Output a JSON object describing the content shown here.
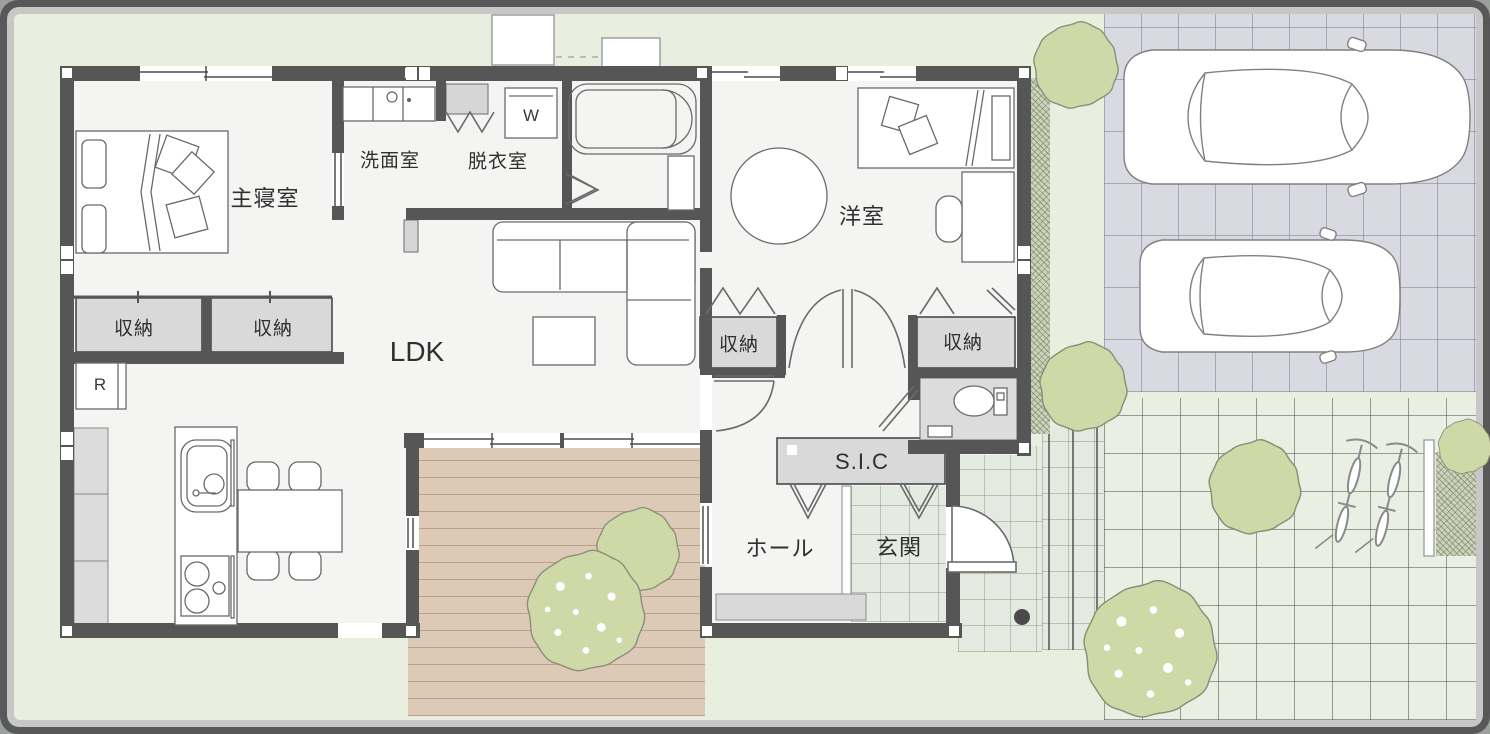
{
  "floorplan": {
    "labels": {
      "master_bedroom": "主寝室",
      "closet": "収納",
      "washroom": "洗面室",
      "dressing_room": "脱衣室",
      "western_room": "洋室",
      "ldk": "LDK",
      "shoe_closet": "S.I.C",
      "hall": "ホール",
      "entrance": "玄関",
      "washer": "W",
      "refrigerator": "R"
    },
    "colors": {
      "wall": "#565656",
      "lawn": "#e8efdf",
      "floor": "#f4f4f3",
      "closet_fill": "#d9d9d9",
      "deck": "#dccab6",
      "tree": "#cfd9a8",
      "tree_outline": "#8a8f7b",
      "driveway": "#d9d9e1",
      "garden_tile": "#e9efe3",
      "entrance_tile": "#e6ebe2",
      "frame_outer": "#585858",
      "frame_inner": "#c7c7c7",
      "furniture_line": "#6a6a6a"
    }
  }
}
